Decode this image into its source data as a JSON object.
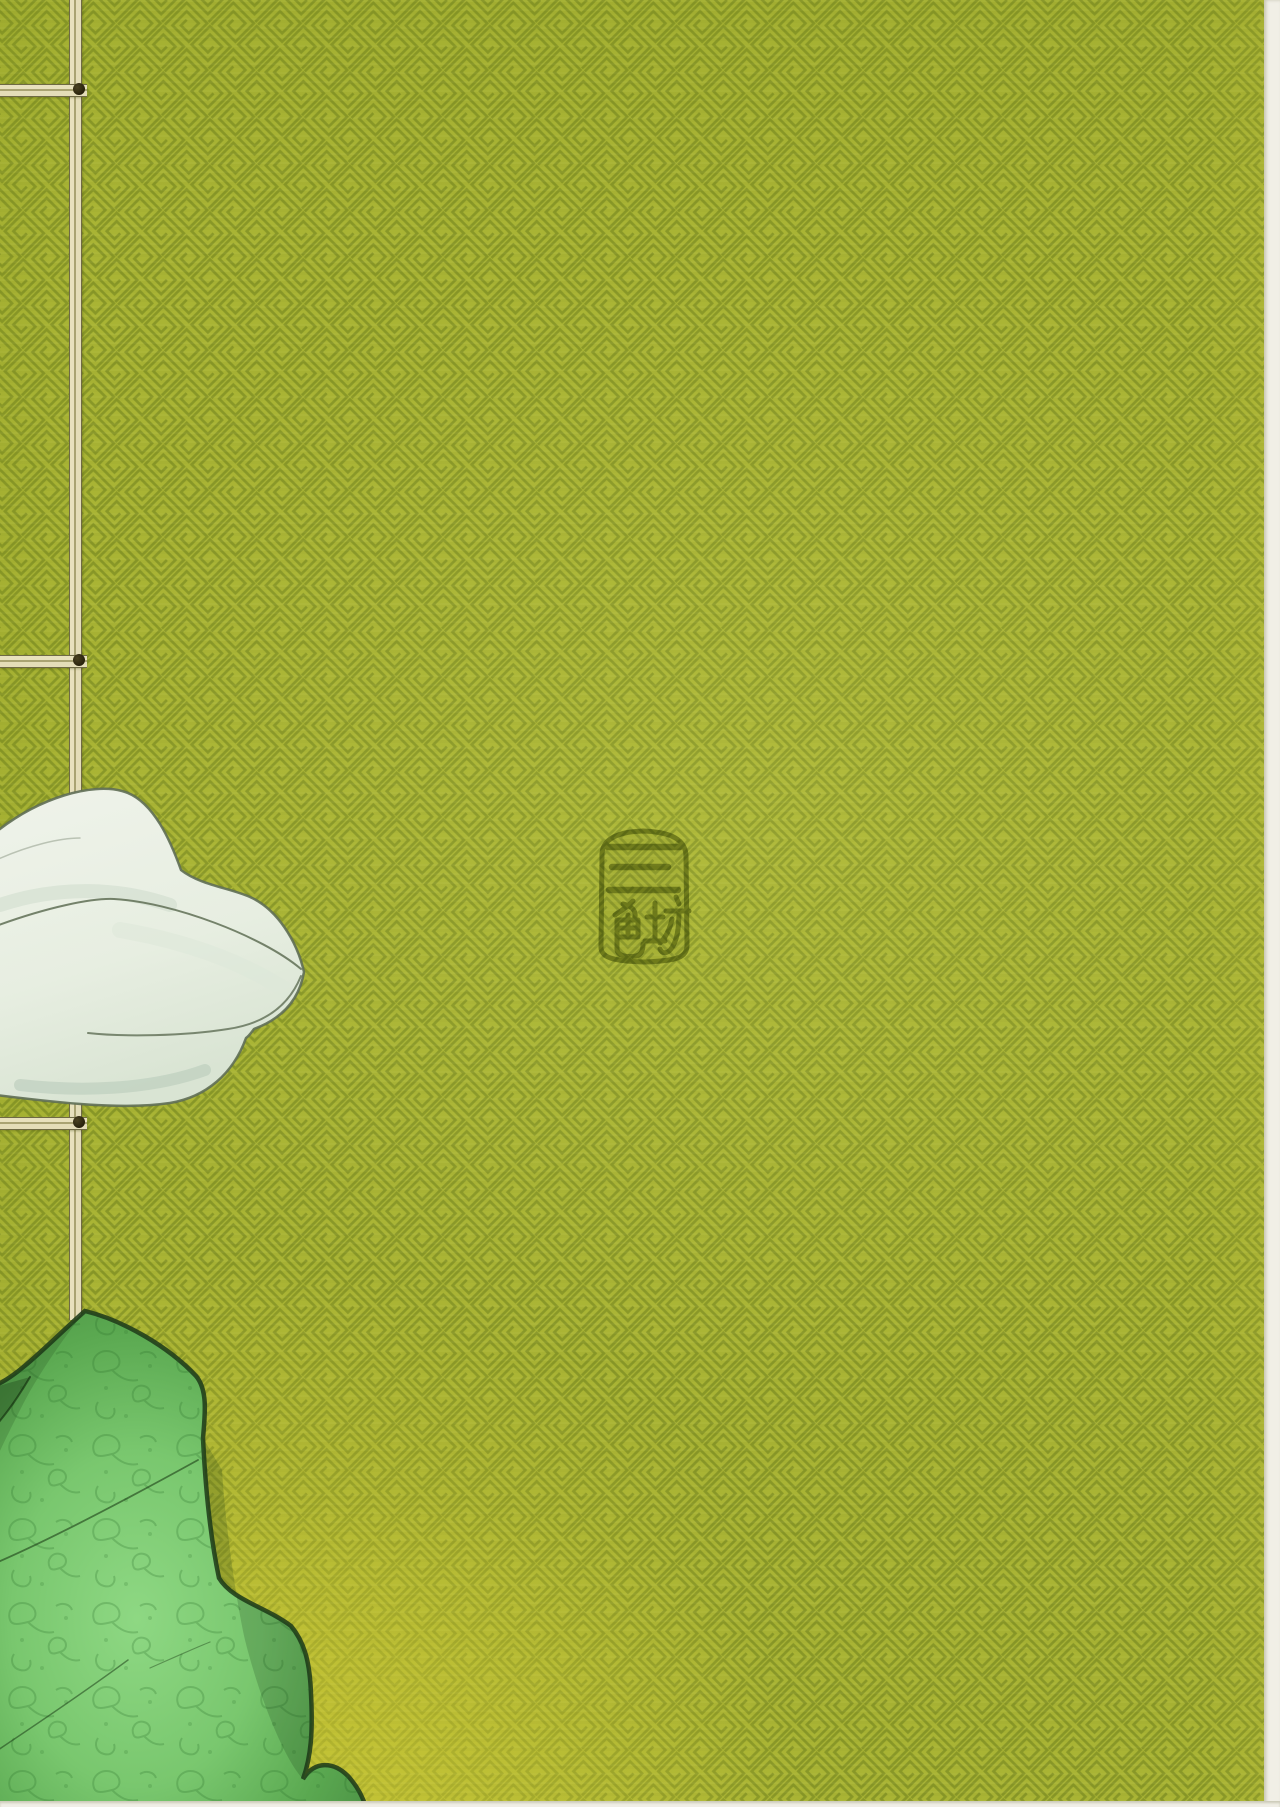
{
  "page": {
    "title": "Back cover of a traditionally stab-bound book",
    "description": "Olive-green sayagata patterned cover with binding thread, white folded cloth, green damask cloth and a stamped seal"
  },
  "background": {
    "pattern": "sayagata interlocking manji key fret, rotated 45 degrees",
    "base_color": "#a9b434",
    "line_color": "#7f9024",
    "bottom_tint": "#c2bd3a"
  },
  "binding": {
    "style": "Japanese stab binding thread",
    "thread_color": "#e4ddb8",
    "thread_edge_color": "#6f6a45",
    "knot_color": "#251f0a",
    "vertical_thread_x": 69,
    "stitches": [
      {
        "y": 84
      },
      {
        "y": 655
      },
      {
        "y": 1117
      }
    ]
  },
  "seal": {
    "text": "三色坊",
    "characters": [
      "三",
      "色",
      "坊"
    ],
    "ink_color": "#5f6c14",
    "position": {
      "x": 592,
      "y": 827,
      "width": 103,
      "height": 139
    }
  },
  "white_fabric": {
    "description": "folded white cloth entering from the left edge",
    "fill": "#eaf0e5",
    "shade_color": "#c7d6c5",
    "outline_color": "#5f6e55"
  },
  "green_fabric": {
    "description": "green damask brocade cloth at bottom-left corner",
    "fill": "#74c369",
    "outline_color": "#203c1a",
    "motif_color": "#256b25"
  },
  "scan_border": {
    "right_color": "#f1efe6",
    "bottom_color": "#f1efe6"
  }
}
